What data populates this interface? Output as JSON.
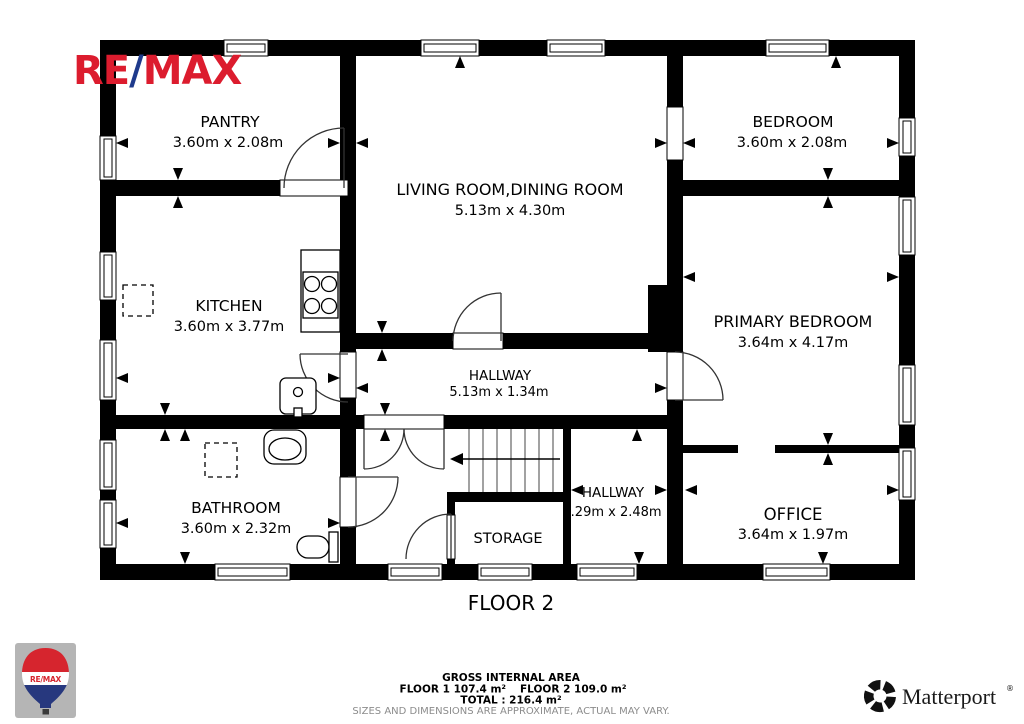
{
  "branding": {
    "remax": {
      "part_re": "RE",
      "part_slash": "/",
      "part_max": "MAX",
      "red": "#DC1C2E",
      "blue": "#1E3A8C",
      "balloon_label": "RE/MAX"
    },
    "matterport": {
      "label": "Matterport",
      "registered": "®"
    }
  },
  "floor": {
    "title": "FLOOR 2"
  },
  "rooms": {
    "pantry": {
      "name": "PANTRY",
      "dims": "3.60m x 2.08m"
    },
    "living": {
      "name": "LIVING ROOM,DINING ROOM",
      "dims": "5.13m x 4.30m"
    },
    "bedroom": {
      "name": "BEDROOM",
      "dims": "3.60m x 2.08m"
    },
    "kitchen": {
      "name": "KITCHEN",
      "dims": "3.60m x 3.77m"
    },
    "primary": {
      "name": "PRIMARY BEDROOM",
      "dims": "3.64m x 4.17m"
    },
    "hallway1": {
      "name": "HALLWAY",
      "dims": "5.13m x 1.34m"
    },
    "bathroom": {
      "name": "BATHROOM",
      "dims": "3.60m x 2.32m"
    },
    "storage": {
      "name": "STORAGE"
    },
    "hallway2": {
      "name": "HALLWAY",
      "dims": "5.29m x 2.48m"
    },
    "office": {
      "name": "OFFICE",
      "dims": "3.64m x 1.97m"
    }
  },
  "footer": {
    "area_title": "GROSS INTERNAL AREA",
    "floor1": "FLOOR 1 107.4 m²",
    "floor2": "FLOOR 2 109.0 m²",
    "total": "TOTAL :  216.4 m²",
    "disclaimer": "SIZES AND DIMENSIONS ARE APPROXIMATE, ACTUAL MAY VARY."
  }
}
